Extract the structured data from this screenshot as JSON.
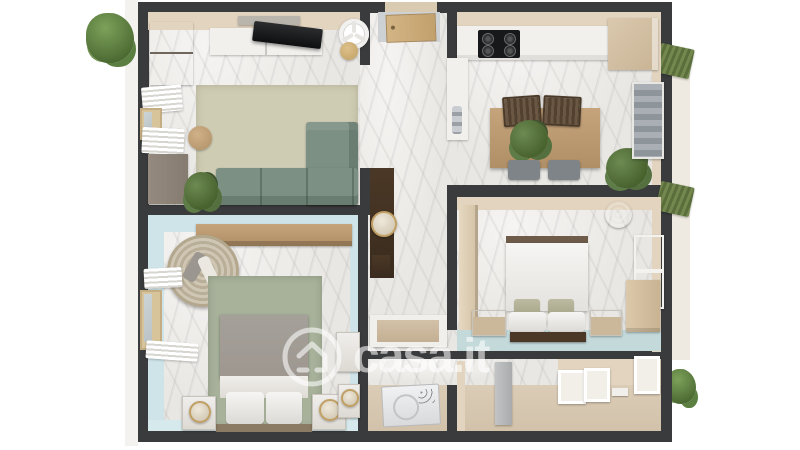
{
  "watermark": {
    "text": "casa.it",
    "icon": "house-icon"
  },
  "scene": {
    "type": "3d-floor-plan-render",
    "rooms": [
      {
        "name": "living-room",
        "furniture": [
          "tv",
          "tv-console",
          "floating-shelf",
          "ceiling-fan",
          "gold-side-table",
          "wardrobe",
          "left-cabinet",
          "window",
          "radiator-shutters",
          "rug",
          "sectional-sofa",
          "round-side-table",
          "potted-plant"
        ]
      },
      {
        "name": "kitchen",
        "furniture": [
          "counter-run",
          "gas-cooktop",
          "corner-cabinet",
          "sink-peninsula",
          "faucet",
          "dining-table",
          "centerpiece-plant",
          "two-chairs",
          "two-stools",
          "corner-plant",
          "roman-shade-window"
        ]
      },
      {
        "name": "hallway",
        "furniture": [
          "entry-door",
          "tall-console",
          "round-mirror"
        ]
      },
      {
        "name": "bedroom-right",
        "furniture": [
          "double-bed",
          "accent-pillows",
          "foot-bench",
          "two-nightstands",
          "side-wardrobe",
          "corner-wardrobe",
          "woven-pendant",
          "window"
        ]
      },
      {
        "name": "bedroom-left",
        "furniture": [
          "double-bed",
          "green-rug",
          "hanging-chair",
          "wall-shelf",
          "two-nightstands-with-mirrors",
          "dresser",
          "vanity-with-mirror",
          "window",
          "radiator-shutters"
        ]
      },
      {
        "name": "bathroom",
        "furniture": [
          "shower-tray",
          "dark-shelf"
        ]
      },
      {
        "name": "laundry-corridor",
        "furniture": [
          "washing-machine",
          "partition-wall",
          "leaning-picture-frames",
          "floor-parcel",
          "wall-panel"
        ]
      }
    ],
    "exterior": [
      "shrub-top-left",
      "shrub-bottom-right",
      "balcony-strip",
      "green-awning-upper",
      "green-awning-lower"
    ]
  },
  "colors": {
    "wall": "#3a3b3c",
    "marble": "#e9e7e3",
    "beige": "#e2d4bf",
    "floorBeige": "#dccdb8",
    "blueWall": "#cfe4e9",
    "tealFloor": "#c3d9da",
    "rugLiving": "#cfccb4",
    "rugBedroom": "#a8b29b",
    "sofa": "#7c9183",
    "wood": "#c5a47c",
    "darkWood": "#4b3826",
    "cabinet": "#948a7f",
    "white": "#f1f0ed",
    "graySeat": "#7e8487",
    "gold": "#c0a064",
    "duvetGray": "#9d9790",
    "wmColor": "rgba(255,255,255,0.58)"
  }
}
